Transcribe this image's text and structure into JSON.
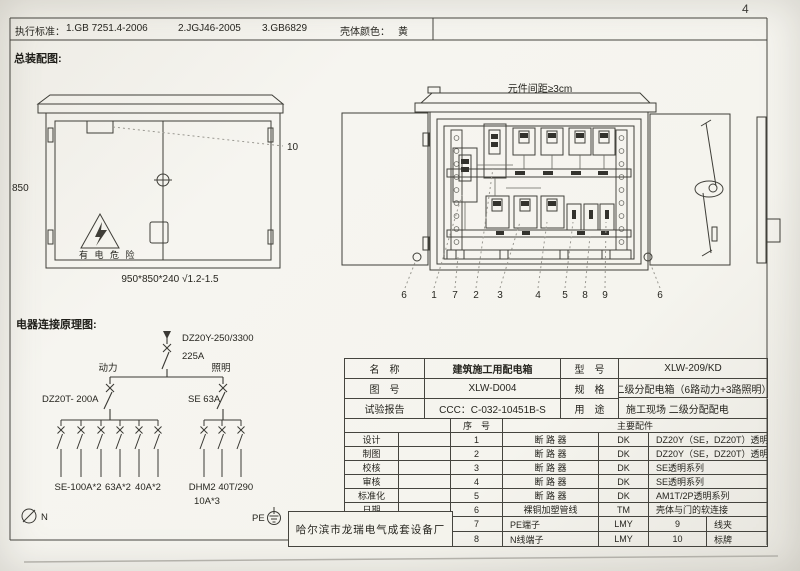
{
  "page": {
    "number": "4"
  },
  "standards_bar": {
    "label": "执行标准：",
    "item1": "1.GB 7251.4-2006",
    "item2": "2.JGJ46-2005",
    "item3": "3.GB6829",
    "color_label": "壳体颜色：",
    "color_value": "黄"
  },
  "assembly": {
    "title": "总装配图:",
    "front": {
      "height": "850",
      "callout_10": "10",
      "warning": "有 电 危 险",
      "size_note": "950*850*240 √1.2-1.5"
    },
    "interior": {
      "gap_note": "元件间距≥3cm",
      "callouts": [
        "6",
        "1",
        "7",
        "2",
        "3",
        "4",
        "5",
        "8",
        "9",
        "6"
      ]
    }
  },
  "schematic": {
    "title": "电器连接原理图:",
    "main_model": "DZ20Y-250/3300",
    "main_rating": "225A",
    "branch_left": "动力",
    "branch_right": "照明",
    "breaker_left": "DZ20T- 200A",
    "breaker_right": "SE 63A",
    "out_left_1": "SE-100A*2",
    "out_left_2": "63A*2",
    "out_left_3": "40A*2",
    "out_right_1": "DHM2 40T/290",
    "out_right_2": "10A*3",
    "n_label": "N",
    "pe_label": "PE"
  },
  "title_block": {
    "name_label": "名　称",
    "name_value": "建筑施工用配电箱",
    "model_label": "型　号",
    "model_value": "XLW-209/KD",
    "drawing_label": "图　号",
    "drawing_value": "XLW-D004",
    "spec_label": "规　格",
    "spec_value": "二级分配电箱（6路动力+3路照明）",
    "report_label": "试验报告",
    "report_value": "CCC：C-032-10451B-S",
    "use_label": "用　途",
    "use_value": "施工现场 二级分配配电",
    "seq_header": "序　号",
    "parts_header": "主要配件",
    "sign_labels": [
      "设计",
      "制图",
      "校核",
      "审核",
      "标准化",
      "日期"
    ],
    "factory": "哈尔滨市龙瑞电气成套设备厂",
    "parts": [
      {
        "no": "1",
        "name": "断 路 器",
        "code": "DK",
        "desc": "DZ20Y（SE，DZ20T）透明系列"
      },
      {
        "no": "2",
        "name": "断 路 器",
        "code": "DK",
        "desc": "DZ20Y（SE，DZ20T）透明系列"
      },
      {
        "no": "3",
        "name": "断 路 器",
        "code": "DK",
        "desc": "SE透明系列"
      },
      {
        "no": "4",
        "name": "断 路 器",
        "code": "DK",
        "desc": "SE透明系列"
      },
      {
        "no": "5",
        "name": "断 路 器",
        "code": "DK",
        "desc": "AM1T/2P透明系列"
      },
      {
        "no": "6",
        "name": "裸铜加塑管线",
        "code": "TM",
        "desc": "壳体与门的软连接"
      },
      {
        "no": "7",
        "name": "PE端子",
        "code": "LMY",
        "no2": "9",
        "desc": "线夹"
      },
      {
        "no": "8",
        "name": "N线端子",
        "code": "LMY",
        "no2": "10",
        "desc": "标牌"
      }
    ]
  }
}
